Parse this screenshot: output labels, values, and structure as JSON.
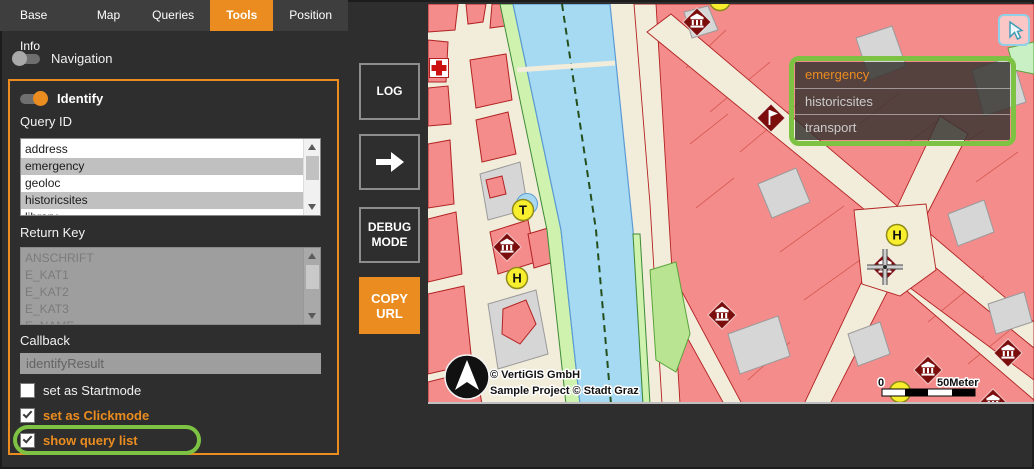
{
  "tabs": {
    "items": [
      "Base Info",
      "Map",
      "Queries",
      "Tools",
      "Position"
    ],
    "active_index": 3
  },
  "navigation_toggle": {
    "label": "Navigation",
    "on": false
  },
  "identify_panel": {
    "toggle_label": "Identify",
    "toggle_on": true,
    "query_id": {
      "label": "Query ID",
      "options": [
        "address",
        "emergency",
        "geoloc",
        "historicsites",
        "library"
      ],
      "selected": [
        "emergency",
        "historicsites"
      ]
    },
    "return_key": {
      "label": "Return Key",
      "options": [
        "ANSCHRIFT",
        "E_KAT1",
        "E_KAT2",
        "E_KAT3",
        "E_NAME"
      ],
      "selected": [],
      "disabled": true
    },
    "callback": {
      "label": "Callback",
      "value": "identifyResult"
    },
    "checkboxes": [
      {
        "label": "set as Startmode",
        "checked": false,
        "accent": false,
        "highlighted": false
      },
      {
        "label": "set as Clickmode",
        "checked": true,
        "accent": true,
        "highlighted": false
      },
      {
        "label": "show query list",
        "checked": true,
        "accent": true,
        "highlighted": true
      }
    ]
  },
  "side_buttons": [
    {
      "label": "LOG",
      "style": "outline"
    },
    {
      "label": "",
      "icon": "arrow-right",
      "style": "outline"
    },
    {
      "label": "DEBUG MODE",
      "style": "outline"
    },
    {
      "label": "COPY URL",
      "style": "accent"
    }
  ],
  "map": {
    "query_popup": {
      "items": [
        {
          "label": "emergency",
          "active": true
        },
        {
          "label": "historicsites",
          "active": false
        },
        {
          "label": "transport",
          "active": false
        }
      ]
    },
    "corner_button": {
      "icon": "cursor"
    },
    "attribution": [
      "© VertiGIS GmbH",
      "Sample Project © Stadt Graz"
    ],
    "scale_bar": {
      "start_label": "0",
      "end_label": "50Meter"
    },
    "markers": [
      {
        "type": "cross",
        "name": "hospital-marker",
        "x": 11,
        "y": 64
      },
      {
        "type": "museum",
        "name": "museum-marker",
        "x": 269,
        "y": 18
      },
      {
        "type": "circle",
        "name": "stop-marker",
        "x": 292,
        "y": -4,
        "letter": ""
      },
      {
        "type": "flag",
        "name": "flag-marker",
        "x": 343,
        "y": 114
      },
      {
        "type": "letter",
        "name": "tram-stop-marker",
        "x": 95,
        "y": 206,
        "letter": "T",
        "halo": true
      },
      {
        "type": "museum",
        "name": "museum-marker",
        "x": 79,
        "y": 243
      },
      {
        "type": "letter",
        "name": "bus-stop-marker",
        "x": 89,
        "y": 274,
        "letter": "H"
      },
      {
        "type": "museum",
        "name": "museum-marker",
        "x": 294,
        "y": 311
      },
      {
        "type": "letter",
        "name": "bus-stop-marker",
        "x": 469,
        "y": 231,
        "letter": "H"
      },
      {
        "type": "circle",
        "name": "stop-marker",
        "x": 472,
        "y": 388,
        "letter": ""
      },
      {
        "type": "museum",
        "name": "museum-marker",
        "x": 500,
        "y": 366
      },
      {
        "type": "museum",
        "name": "museum-marker",
        "x": 580,
        "y": 349
      },
      {
        "type": "museum",
        "name": "museum-marker",
        "x": 565,
        "y": 399
      },
      {
        "type": "museum-crosshair",
        "name": "identify-location-marker",
        "x": 457,
        "y": 263
      }
    ]
  },
  "colors": {
    "accent": "#ea8c1f",
    "annotation_green": "#7dc242",
    "selection_gray": "#c0c0c0",
    "map_building": "#f48c8c",
    "map_building_outline": "#b22222",
    "map_water": "#a6d9f2",
    "map_greenway": "#cff2ae",
    "map_street": "#f2ecda",
    "marker_dark_red": "#7b0d0d",
    "marker_yellow": "#f7ee2e"
  }
}
